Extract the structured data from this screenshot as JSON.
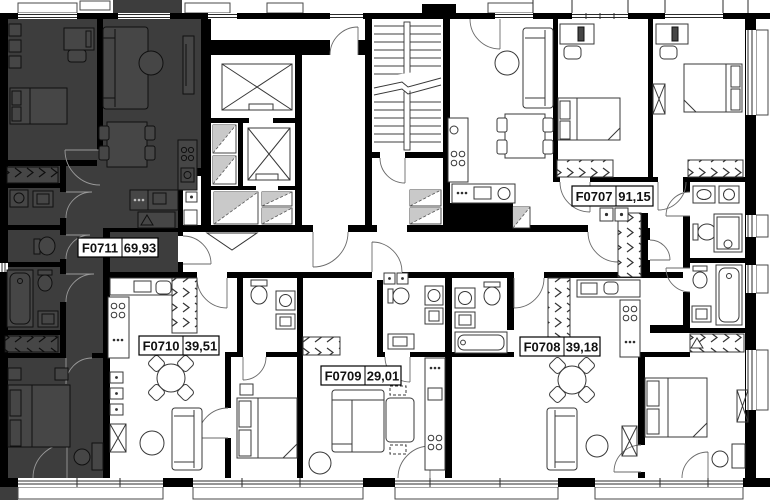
{
  "units": [
    {
      "id": "F0707",
      "area": "91,15",
      "highlighted": false
    },
    {
      "id": "F0708",
      "area": "39,18",
      "highlighted": false
    },
    {
      "id": "F0709",
      "area": "29,01",
      "highlighted": false
    },
    {
      "id": "F0710",
      "area": "39,51",
      "highlighted": false
    },
    {
      "id": "F0711",
      "area": "69,93",
      "highlighted": true
    }
  ],
  "colors": {
    "wall": "#000000",
    "highlighted_unit_fill": "#3d3d3d",
    "background": "#ffffff",
    "label_text": "#111111"
  },
  "icons": [
    "elevator-icon",
    "staircase-icon",
    "bed-icon",
    "sofa-icon",
    "dining-table-icon",
    "bathtub-icon",
    "toilet-icon",
    "sink-icon",
    "washing-machine-icon",
    "stove-icon",
    "fridge-icon",
    "wardrobe-icon",
    "door-swing-icon",
    "window-icon"
  ]
}
